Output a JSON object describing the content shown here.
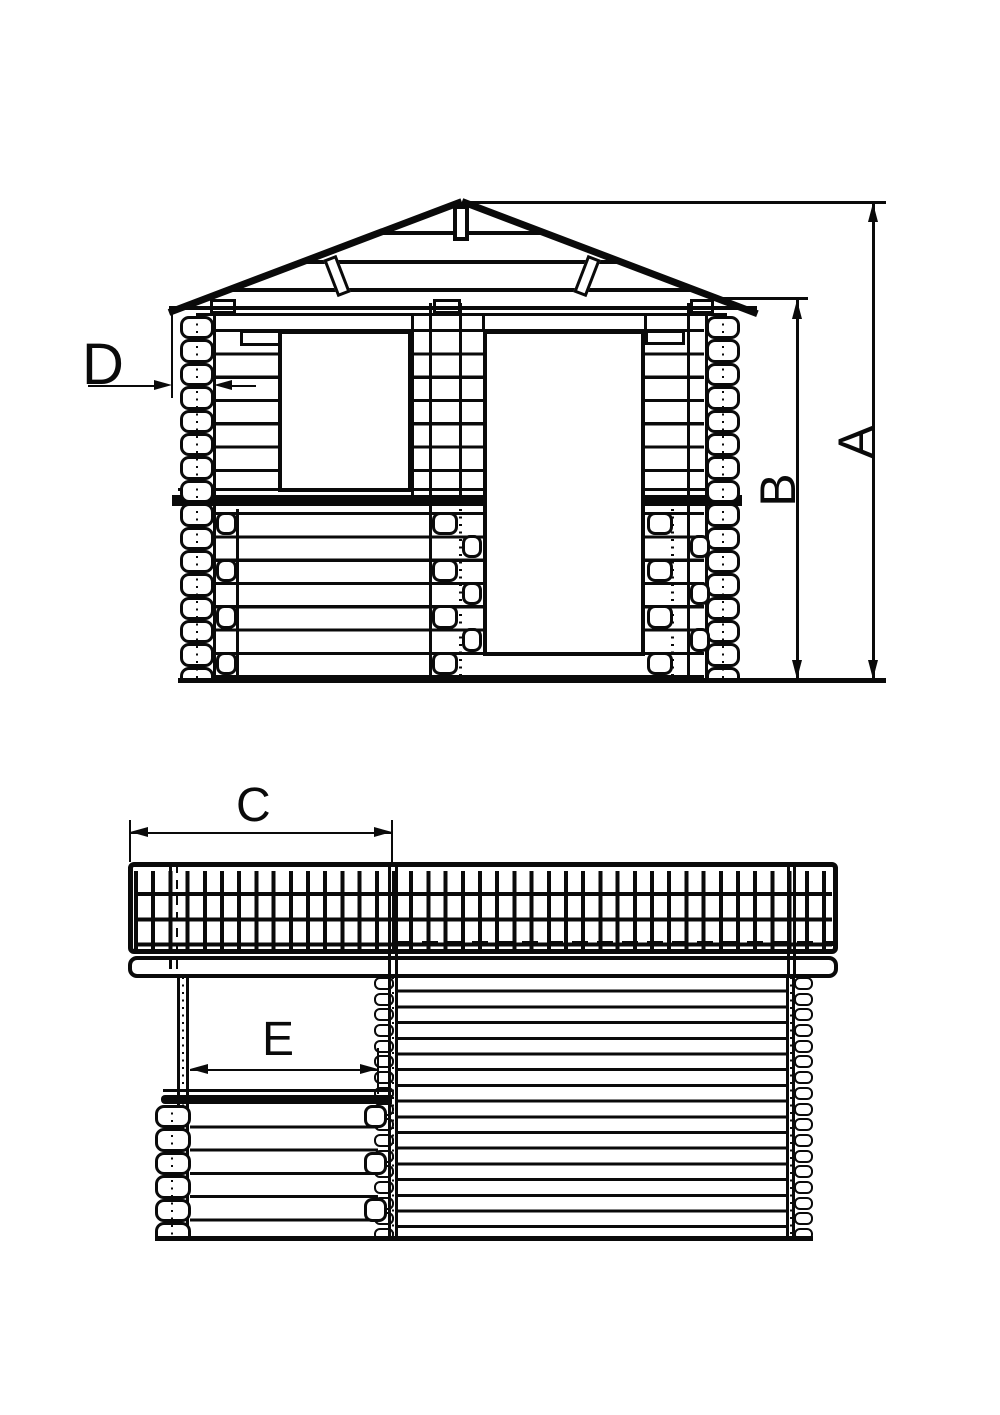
{
  "dimension_labels": {
    "a": "A",
    "b": "B",
    "c": "C",
    "d": "D",
    "e": "E"
  },
  "colors": {
    "line": "#0a0a0a",
    "paper": "#ffffff"
  }
}
